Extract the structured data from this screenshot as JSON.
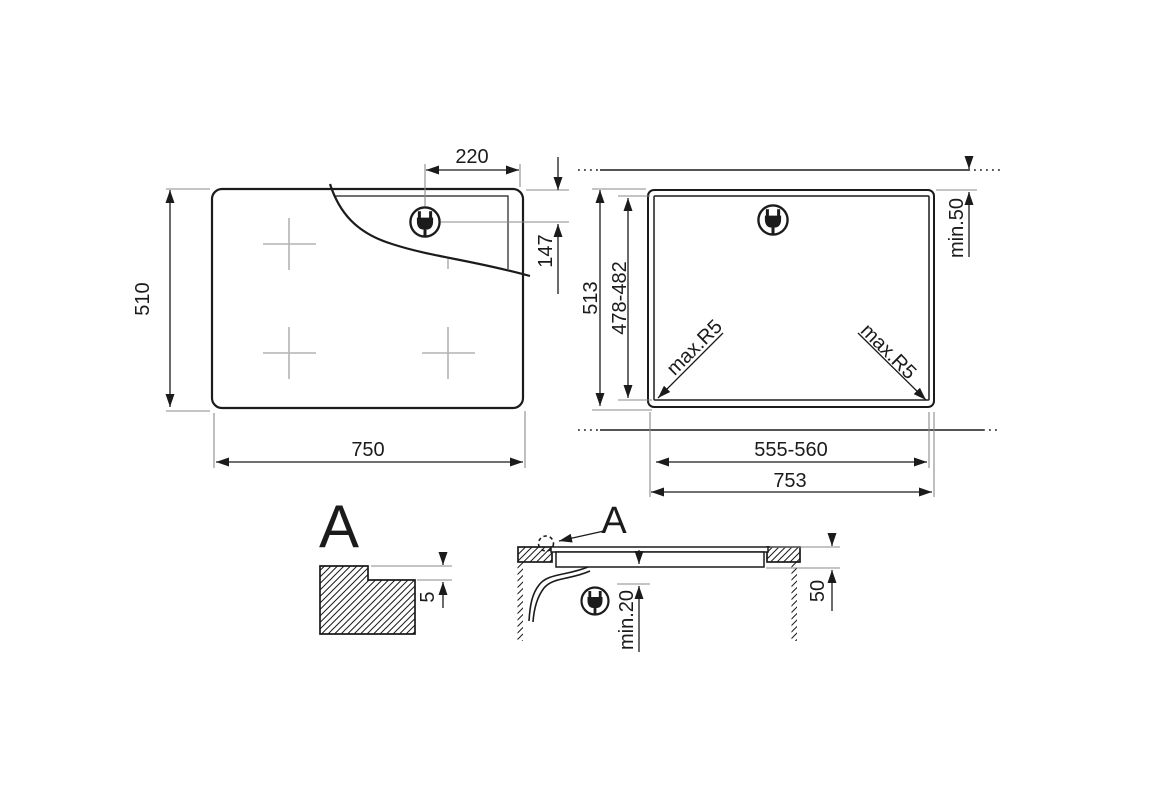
{
  "palette": {
    "line": "#1b1b1b",
    "extension_line": "#8a8a8a",
    "burner_mark": "#b4b4b4",
    "background": "#ffffff"
  },
  "plan_view": {
    "width": "750",
    "height": "510",
    "plug_offset_x": "220",
    "plug_offset_y": "147",
    "plug_icon": "power-plug-icon"
  },
  "cutout_view": {
    "overall_width": "753",
    "overall_height": "513",
    "cutout_width": "555-560",
    "cutout_height": "478-482",
    "rear_clearance": "min.50",
    "corner_radius_left": "max.R5",
    "corner_radius_right": "max.R5",
    "plug_icon": "power-plug-icon"
  },
  "detail_view": {
    "label": "A",
    "rebate_depth": "5"
  },
  "section_view": {
    "detail_ref_label": "A",
    "recess_depth": "50",
    "bottom_clearance": "min.20",
    "plug_icon": "power-plug-icon"
  }
}
